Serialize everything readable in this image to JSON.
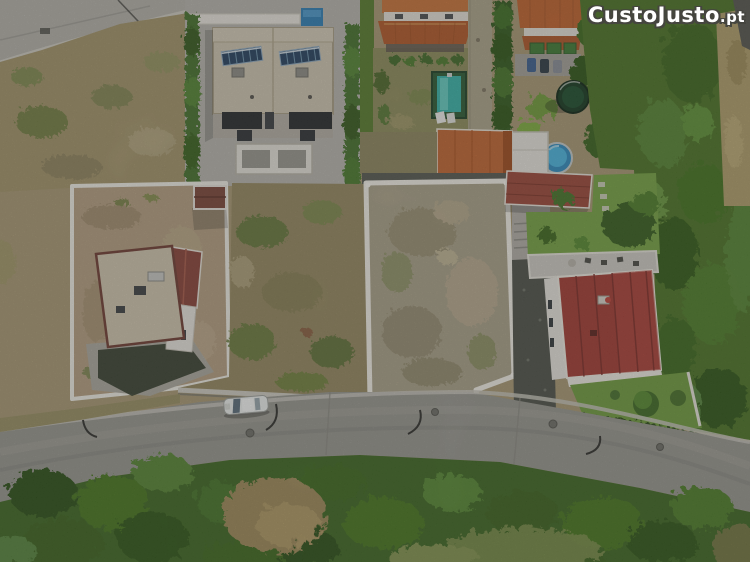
{
  "meta": {
    "kind": "aerial-drone-photo",
    "description": "Top-down aerial photo of a residential street: two white-walled vacant building plots in the center, a modern flat-roof duplex with solar panels top-left, terracotta-roof houses with pools at top, a red-roof villa with garden on the right, a curving asphalt road with one parked white car, and dense green vegetation along the bottom and right."
  },
  "watermark": {
    "brand": "CustoJusto",
    "tld": ".pt",
    "text_color": "#ffffff",
    "outline_color": "#45453f"
  },
  "scene_features": [
    "street-top-left",
    "dry-field-top-left",
    "modern-duplex-flat-roof",
    "solar-panel-arrays",
    "rooftop-lap-pool",
    "boxwood-hedges",
    "orange-roof-house",
    "backyard-framed-pool",
    "sun-loungers",
    "gravel-driveway",
    "tall-hedge-row",
    "awning-house-with-cars",
    "trampoline",
    "round-above-ground-pool",
    "white-annex-building",
    "orange-outbuilding-roof",
    "left-walled-plot-with-house",
    "garden-shed",
    "central-vacant-walled-plot",
    "red-garage-roof",
    "villa-garden-lawn",
    "villa-terrace",
    "red-roof-villa",
    "green-field-right",
    "dry-grass-strip-right",
    "asphalt-street",
    "parked-white-car",
    "street-lamps",
    "manhole-covers",
    "roadside-tree-canopy",
    "dry-brown-patch"
  ],
  "palette": {
    "asphalt": "#9b9a92",
    "concrete": "#b6b3aa",
    "dirt": "#b0a07e",
    "plot_soil": "#aba188",
    "wall_white": "#f2efe6",
    "field_green": "#4a7423",
    "lawn_green": "#6f9c3c",
    "roof_red": "#a63a31",
    "roof_orange": "#c2652f",
    "roof_beige": "#cfc6b1",
    "solar_blue": "#24405e",
    "pool_teal": "#40b4a8",
    "pool_blue": "#3f9ecb"
  }
}
